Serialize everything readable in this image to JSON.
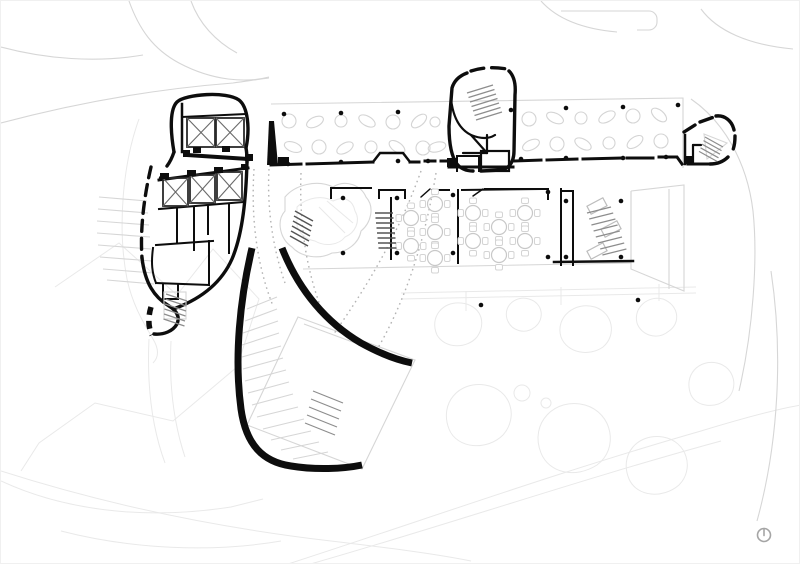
{
  "colors": {
    "paper": "#ffffff",
    "ink": "#0d0d0d",
    "context": "#d6d6d6",
    "faint": "#e9e9e9",
    "tree": "#d4d4d4"
  },
  "icons": {
    "compass": "north-arrow-icon"
  },
  "canopy": {
    "columns": [
      [
        283,
        113
      ],
      [
        340,
        112
      ],
      [
        397,
        111
      ],
      [
        510,
        109
      ],
      [
        565,
        107
      ],
      [
        622,
        106
      ],
      [
        677,
        104
      ],
      [
        287,
        163
      ],
      [
        340,
        161
      ],
      [
        397,
        160
      ],
      [
        427,
        160
      ],
      [
        520,
        158
      ],
      [
        565,
        157
      ],
      [
        622,
        157
      ],
      [
        665,
        156
      ],
      [
        480,
        304
      ],
      [
        637,
        299
      ]
    ],
    "trees": [
      [
        288,
        120,
        "c",
        7
      ],
      [
        314,
        121,
        "o",
        -25
      ],
      [
        340,
        120,
        "c",
        6
      ],
      [
        366,
        120,
        "o",
        30
      ],
      [
        392,
        121,
        "c",
        7
      ],
      [
        418,
        120,
        "o",
        -40
      ],
      [
        434,
        121,
        "c",
        5
      ],
      [
        528,
        118,
        "c",
        7
      ],
      [
        554,
        117,
        "o",
        25
      ],
      [
        580,
        117,
        "c",
        6
      ],
      [
        606,
        116,
        "o",
        -30
      ],
      [
        632,
        115,
        "c",
        7
      ],
      [
        658,
        114,
        "o",
        40
      ],
      [
        292,
        146,
        "o",
        20
      ],
      [
        318,
        146,
        "c",
        7
      ],
      [
        344,
        147,
        "o",
        -30
      ],
      [
        370,
        146,
        "c",
        6
      ],
      [
        396,
        146,
        "o",
        35
      ],
      [
        422,
        147,
        "c",
        7
      ],
      [
        436,
        146,
        "o",
        -15
      ],
      [
        530,
        144,
        "o",
        -25
      ],
      [
        556,
        143,
        "c",
        7
      ],
      [
        582,
        143,
        "o",
        30
      ],
      [
        608,
        142,
        "c",
        6
      ],
      [
        634,
        141,
        "o",
        -35
      ],
      [
        660,
        140,
        "c",
        7
      ]
    ]
  },
  "middle_band": {
    "columns": [
      [
        342,
        197
      ],
      [
        342,
        252
      ],
      [
        396,
        197
      ],
      [
        396,
        252
      ],
      [
        452,
        194
      ],
      [
        452,
        252
      ],
      [
        547,
        191
      ],
      [
        547,
        256
      ],
      [
        565,
        200
      ],
      [
        620,
        200
      ],
      [
        565,
        256
      ],
      [
        620,
        256
      ]
    ],
    "tables": [
      [
        410,
        217
      ],
      [
        410,
        245
      ],
      [
        434,
        203
      ],
      [
        434,
        231
      ],
      [
        434,
        257
      ],
      [
        472,
        212
      ],
      [
        472,
        240
      ],
      [
        498,
        226
      ],
      [
        498,
        254
      ],
      [
        524,
        212
      ],
      [
        524,
        240
      ]
    ],
    "benches": [
      [
        596,
        205,
        -28
      ],
      [
        610,
        228,
        -28
      ],
      [
        596,
        250,
        -28
      ]
    ]
  },
  "left_pod": {
    "xboxes": [
      [
        186,
        117,
        28,
        29
      ],
      [
        215,
        117,
        28,
        29
      ],
      [
        162,
        177,
        25,
        28
      ],
      [
        189,
        174,
        25,
        28
      ],
      [
        216,
        171,
        25,
        28
      ]
    ],
    "columns": [
      [
        160,
        177
      ],
      [
        283,
        161
      ],
      [
        450,
        162
      ],
      [
        688,
        160
      ]
    ]
  },
  "blocks": [
    [
      182,
      149,
      7,
      7
    ],
    [
      244,
      153,
      8,
      7
    ],
    [
      192,
      146,
      8,
      6
    ],
    [
      221,
      145,
      8,
      6
    ],
    [
      159,
      172,
      9,
      6
    ],
    [
      186,
      169,
      9,
      6
    ],
    [
      213,
      166,
      9,
      6
    ],
    [
      240,
      163,
      7,
      6
    ],
    [
      277,
      156,
      11,
      9
    ],
    [
      446,
      157,
      9,
      9
    ],
    [
      684,
      155,
      8,
      8
    ]
  ],
  "stairs": [
    {
      "x1": 466,
      "y1": 92,
      "x2": 492,
      "y2": 84,
      "dx": 1.5,
      "dy": 4.5,
      "n": 7,
      "dark": false
    },
    {
      "x1": 374,
      "y1": 212,
      "x2": 392,
      "y2": 212,
      "dx": 0.5,
      "dy": 5,
      "n": 8,
      "dark": true
    },
    {
      "x1": 586,
      "y1": 212,
      "x2": 610,
      "y2": 206,
      "dx": 2.2,
      "dy": 6,
      "n": 8,
      "dark": false
    },
    {
      "x1": 294,
      "y1": 210,
      "x2": 312,
      "y2": 220,
      "dx": -1,
      "dy": 5,
      "n": 6,
      "dark": true
    },
    {
      "x1": 165,
      "y1": 293,
      "x2": 186,
      "y2": 300,
      "dx": -0.5,
      "dy": 5,
      "n": 6,
      "dark": false
    },
    {
      "x1": 704,
      "y1": 136,
      "x2": 722,
      "y2": 146,
      "dx": -1.5,
      "dy": 3.6,
      "n": 5,
      "dark": false
    },
    {
      "x1": 312,
      "y1": 390,
      "x2": 342,
      "y2": 402,
      "dx": -2,
      "dy": 8,
      "n": 5,
      "dark": false
    }
  ],
  "terraces": {
    "center": [
      [
        246,
        308,
        276,
        296
      ],
      [
        244,
        320,
        276,
        308
      ],
      [
        242,
        332,
        277,
        320
      ],
      [
        241,
        344,
        278,
        332
      ],
      [
        241,
        356,
        280,
        345
      ],
      [
        242,
        368,
        282,
        357
      ],
      [
        244,
        380,
        285,
        369
      ],
      [
        247,
        392,
        288,
        381
      ],
      [
        251,
        404,
        292,
        393
      ],
      [
        256,
        416,
        297,
        406
      ],
      [
        262,
        428,
        303,
        418
      ],
      [
        270,
        439,
        310,
        430
      ],
      [
        280,
        449,
        318,
        441
      ],
      [
        292,
        458,
        327,
        451
      ]
    ],
    "left": [
      [
        98,
        196,
        146,
        200
      ],
      [
        97,
        208,
        147,
        212
      ],
      [
        96,
        220,
        148,
        224
      ],
      [
        96,
        232,
        149,
        236
      ],
      [
        97,
        244,
        150,
        248
      ],
      [
        99,
        256,
        151,
        260
      ],
      [
        102,
        268,
        152,
        272
      ],
      [
        106,
        279,
        153,
        283
      ]
    ]
  }
}
